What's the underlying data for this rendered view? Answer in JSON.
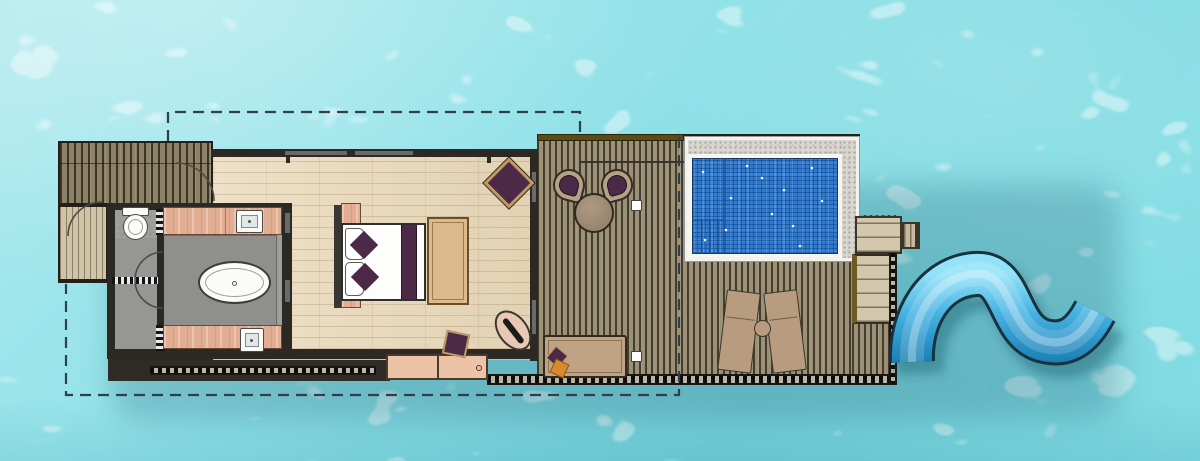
{
  "scene": {
    "type": "floor-plan",
    "subject": "overwater-pool-villa-with-water-slide",
    "canvas": {
      "width": 1200,
      "height": 461
    },
    "visible_text": "none"
  },
  "palette": {
    "lagoon_water": "#86dee5",
    "lagoon_caustic": "#ffffff",
    "deck_plank": "#9c9076",
    "deck_plank_gap": "#433d2d",
    "entry_deck_plank": "#8d8166",
    "light_deck_plank": "#cfc4a6",
    "wood_floor": "#ead9ba",
    "tile_floor": "#9c9c9a",
    "wall": "#2c2824",
    "counter_salmon": "#e2ae93",
    "fixture_white": "#fafaf7",
    "accent_plum": "#4c2a47",
    "accent_orange": "#d98a2b",
    "rattan_tan": "#b4a286",
    "lounger_tan": "#b79c80",
    "bench_tan": "#dcba8c",
    "pool_water": "#2d7bcd",
    "pool_stone": "#d8d6ce",
    "pool_coping": "#f4f4f0",
    "slide_blue_light": "#93e2f8",
    "slide_blue_deep": "#1b7fb4",
    "slide_outline": "#17333f",
    "boundary_dash": "#2e4149",
    "trim_olive": "#5c4c14"
  },
  "plan": {
    "boundary": "dashed-outline",
    "areas": [
      {
        "name": "entry-deck",
        "items": [
          "upper-deck",
          "lower-deck",
          "entry-door-swing"
        ]
      },
      {
        "name": "bathroom",
        "items": [
          "toilet",
          "vanity-top-with-sink",
          "vanity-bottom-with-sink",
          "freestanding-bathtub",
          "shower-doors"
        ]
      },
      {
        "name": "bedroom",
        "items": [
          "double-bed",
          "headboard",
          "nightstand-top",
          "nightstand-bottom",
          "foot-bench",
          "lounge-chair",
          "stool",
          "standing-mirror",
          "console-cabinet"
        ]
      },
      {
        "name": "rear-deck",
        "items": [
          "round-table",
          "papasan-chair-left",
          "papasan-chair-right",
          "daybed",
          "deck-light-upper",
          "deck-light-lower"
        ]
      },
      {
        "name": "pool-terrace",
        "items": [
          "private-pool",
          "pool-bench-steps",
          "sun-lounger-left",
          "sun-lounger-right",
          "side-table"
        ]
      },
      {
        "name": "water-access",
        "items": [
          "slide-platform",
          "platform-step",
          "water-ladder",
          "water-slide"
        ]
      }
    ]
  }
}
